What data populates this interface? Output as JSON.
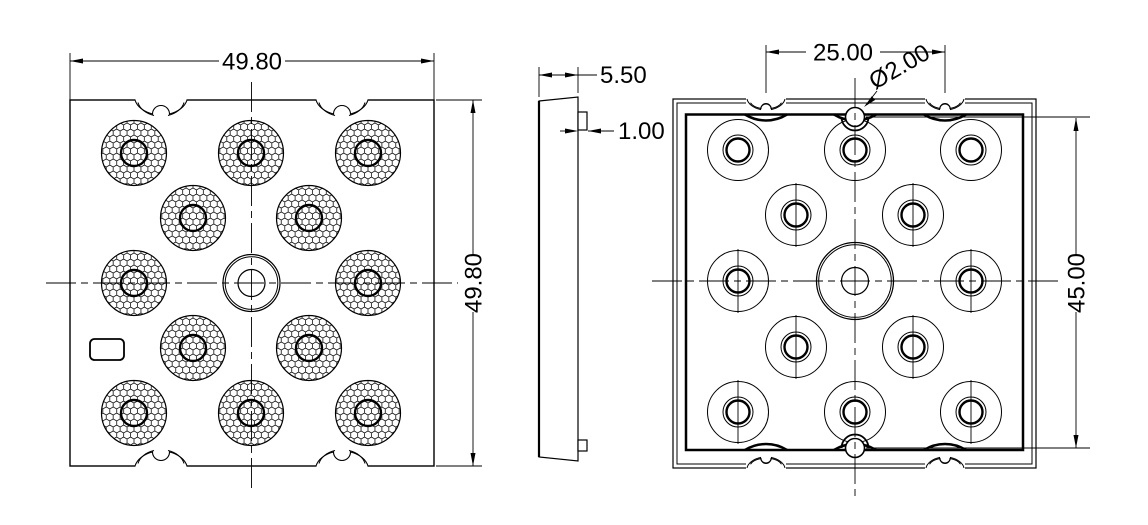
{
  "drawing": {
    "type": "engineering-drawing",
    "part": "square LED lens array plate",
    "colors": {
      "background": "#ffffff",
      "line": "#000000"
    },
    "views": {
      "front": {
        "label": "front-view-lens-array",
        "dim_width": "49.80",
        "dim_height": "49.80",
        "textured_lens_count": 12,
        "center_optic_count": 1,
        "edge_notches": 4
      },
      "side": {
        "label": "side-profile-view",
        "dim_thickness": "5.50",
        "dim_tab": "1.00",
        "tab_count": 2
      },
      "back": {
        "label": "back-view-lens-pockets",
        "dim_notch_spacing": "25.00",
        "dim_hole": "Ø2.00",
        "dim_hole_spacing": "45.00",
        "lens_pocket_count": 12,
        "alignment_hole_count": 2
      }
    }
  }
}
